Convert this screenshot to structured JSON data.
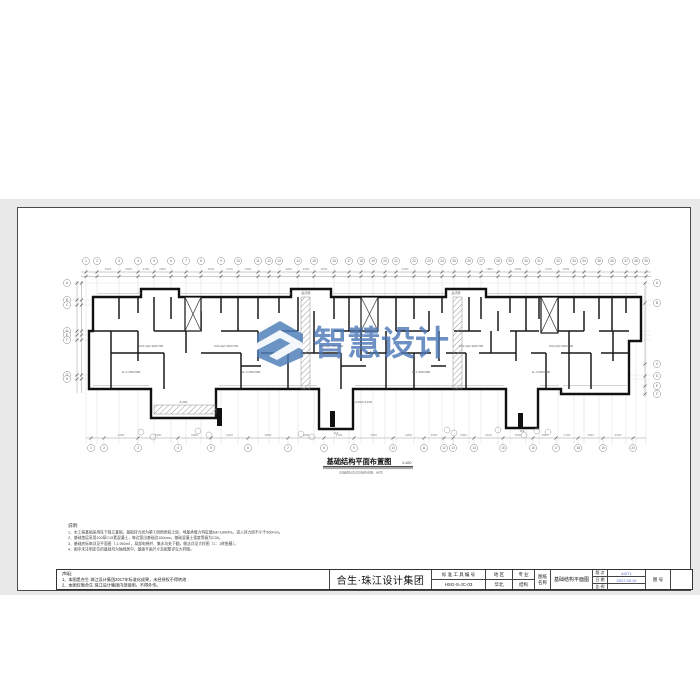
{
  "page": {
    "backdrop_color": "#e9e9e9",
    "sheet_color": "#ffffff"
  },
  "watermark": {
    "text": "智慧设计",
    "color": "#4a7ab8"
  },
  "plan": {
    "title": "基础结构平面布置图",
    "title_scale": "1:100",
    "subtitle": "（基础底标高详见结构说明，余同）",
    "grid_x_top": [
      85,
      96,
      118,
      137,
      153,
      170,
      185,
      200,
      220,
      237,
      257,
      268,
      278,
      297,
      313,
      333,
      348,
      360,
      372,
      384,
      395,
      413,
      428,
      441,
      453,
      468,
      480,
      497,
      509,
      525,
      538,
      557,
      573,
      583,
      598,
      611,
      625,
      635,
      645
    ],
    "grid_x_bottom": [
      90,
      103,
      137,
      177,
      210,
      247,
      287,
      323,
      353,
      392,
      423,
      443,
      452,
      473,
      502,
      532,
      555,
      577,
      602,
      632
    ],
    "grid_y_left": [
      282,
      299,
      304,
      330,
      334,
      339,
      374,
      378
    ],
    "grid_y_right": [
      282,
      302,
      363,
      375,
      385,
      393
    ],
    "dim_values": [
      "3300",
      "2600",
      "2100",
      "1800",
      "3900",
      "2700",
      "1500",
      "4200"
    ],
    "micro_labels": [
      {
        "x": 150,
        "y": 346,
        "t": "4-KL1(2) 300×700"
      },
      {
        "x": 225,
        "y": 346,
        "t": "4-KL2(2) 300×700"
      },
      {
        "x": 330,
        "y": 346,
        "t": "4-KL3(2) 300×700"
      },
      {
        "x": 470,
        "y": 346,
        "t": "4-KL1(2) 300×700"
      },
      {
        "x": 560,
        "y": 346,
        "t": "4-KL2(2) 300×700"
      },
      {
        "x": 130,
        "y": 372,
        "t": "JL-1 250×500"
      },
      {
        "x": 250,
        "y": 372,
        "t": "JL-2 250×500"
      },
      {
        "x": 420,
        "y": 372,
        "t": "JL-1 250×500"
      },
      {
        "x": 540,
        "y": 372,
        "t": "JL-3 250×500"
      },
      {
        "x": 305,
        "y": 293,
        "t": "后浇带"
      },
      {
        "x": 455,
        "y": 293,
        "t": "后浇带"
      },
      {
        "x": 362,
        "y": 402,
        "t": "-4.200/-4.100"
      },
      {
        "x": 182,
        "y": 402,
        "t": "-4.200"
      },
      {
        "x": 335,
        "y": 433,
        "t": "2-2"
      },
      {
        "x": 521,
        "y": 431,
        "t": "3-3"
      }
    ]
  },
  "notes": {
    "header": "说明:",
    "lines": [
      "1、本工程基础采用柱下独立基础，基础持力层为第②层粉质粘土层，地基承载力特征值fak=180kPa，进入持力层不小于500mm。",
      "2、基础垫层采用100厚C15素混凝土，每边宽出基础边100mm，基础混凝土强度等级为C30。",
      "3、基础底标高详见平面图（-1.950m），局部电梯井、集水坑处下翻，做法详见大样图（1：1砖胎膜）。",
      "4、图中未注明定位的基础均为轴线居中，基础平面尺寸及配筋详见大样图。"
    ]
  },
  "titleblock": {
    "statement_header": "声明:",
    "statement_line1": "1、本图是合生·珠江设计集团2017年标准化成果，未经授权不得转改",
    "statement_line2": "2、本图仅限合生·珠江设计集团内部使用，不得外传。",
    "company": "合生·珠江设计集团",
    "code_label": "标 准 工 具 编 号",
    "code_value": "HSG-S-JC-03",
    "region_label": "地  区",
    "region_value": "华北",
    "spec_label": "专  业",
    "spec_value": "结构",
    "name_label_1": "图纸",
    "name_label_2": "名称",
    "drawing_name": "基础结构平面图",
    "rev_label": "版 次",
    "rev_value": "A/0T1",
    "date_label": "日 期",
    "date_value": "2017.05.10",
    "scale_label": "比 例",
    "scale_value": "",
    "sheet_no_label": "图 号",
    "sheet_no_value": ""
  }
}
